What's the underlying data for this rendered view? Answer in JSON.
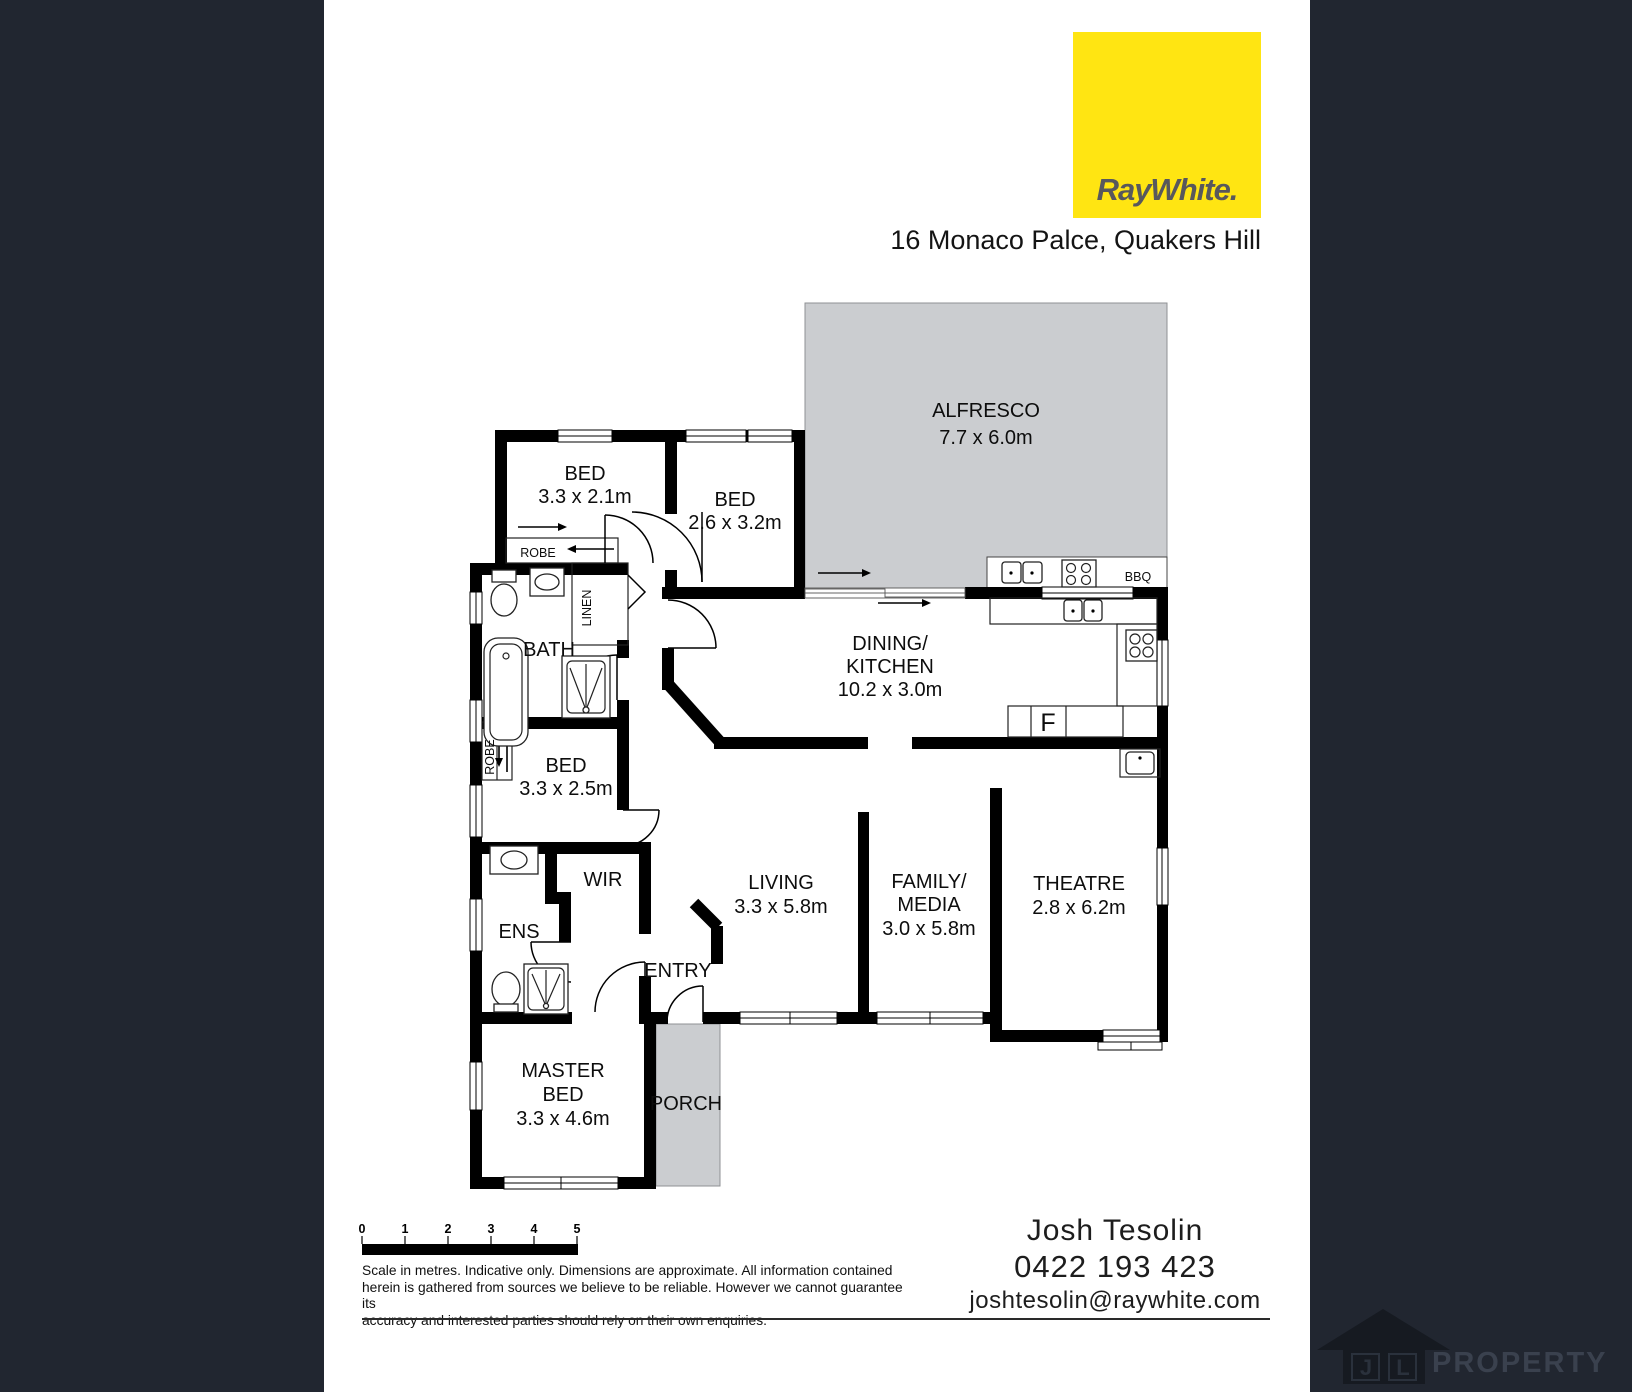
{
  "header": {
    "brand": "RayWhite.",
    "address": "16 Monaco Palce, Quakers Hill"
  },
  "plan": {
    "alfresco_name": "ALFRESCO",
    "alfresco_dims": "7.7 x 6.0m",
    "bed1_name": "BED",
    "bed1_dims": "3.3 x 2.1m",
    "bed2_name": "BED",
    "bed2_dims": "2.6 x 3.2m",
    "dining_name1": "DINING/",
    "dining_name2": "KITCHEN",
    "dining_dims": "10.2 x 3.0m",
    "bath_name": "BATH",
    "bed3_name": "BED",
    "bed3_dims": "3.3 x 2.5m",
    "wir_name": "WIR",
    "ens_name": "ENS",
    "living_name": "LIVING",
    "living_dims": "3.3 x 5.8m",
    "family_name1": "FAMILY/",
    "family_name2": "MEDIA",
    "family_dims": "3.0 x 5.8m",
    "theatre_name": "THEATRE",
    "theatre_dims": "2.8 x 6.2m",
    "entry_name": "ENTRY",
    "master_name1": "MASTER",
    "master_name2": "BED",
    "master_dims": "3.3 x 4.6m",
    "porch_name": "PORCH",
    "robe_top": "ROBE",
    "robe_mid": "ROBE",
    "linen": "LINEN",
    "bbq": "BBQ",
    "fridge": "F"
  },
  "scale": {
    "ticks": [
      "0",
      "1",
      "2",
      "3",
      "4",
      "5"
    ]
  },
  "disclaimer": {
    "line1": "Scale in metres. Indicative only. Dimensions are approximate. All information contained",
    "line2": "herein is gathered from sources we believe to be reliable. However we cannot guarantee its",
    "line3": "accuracy and interested parties should rely on their own enquiries."
  },
  "agent": {
    "name": "Josh Tesolin",
    "phone": "0422 193 423",
    "email": "joshtesolin@raywhite.com"
  },
  "watermark": {
    "letter1": "J",
    "letter2": "L",
    "word": "PROPERTY"
  },
  "colors": {
    "brand_yellow": "#ffe512",
    "background_dark": "#212630",
    "plan_gray": "#cbcdd0"
  }
}
